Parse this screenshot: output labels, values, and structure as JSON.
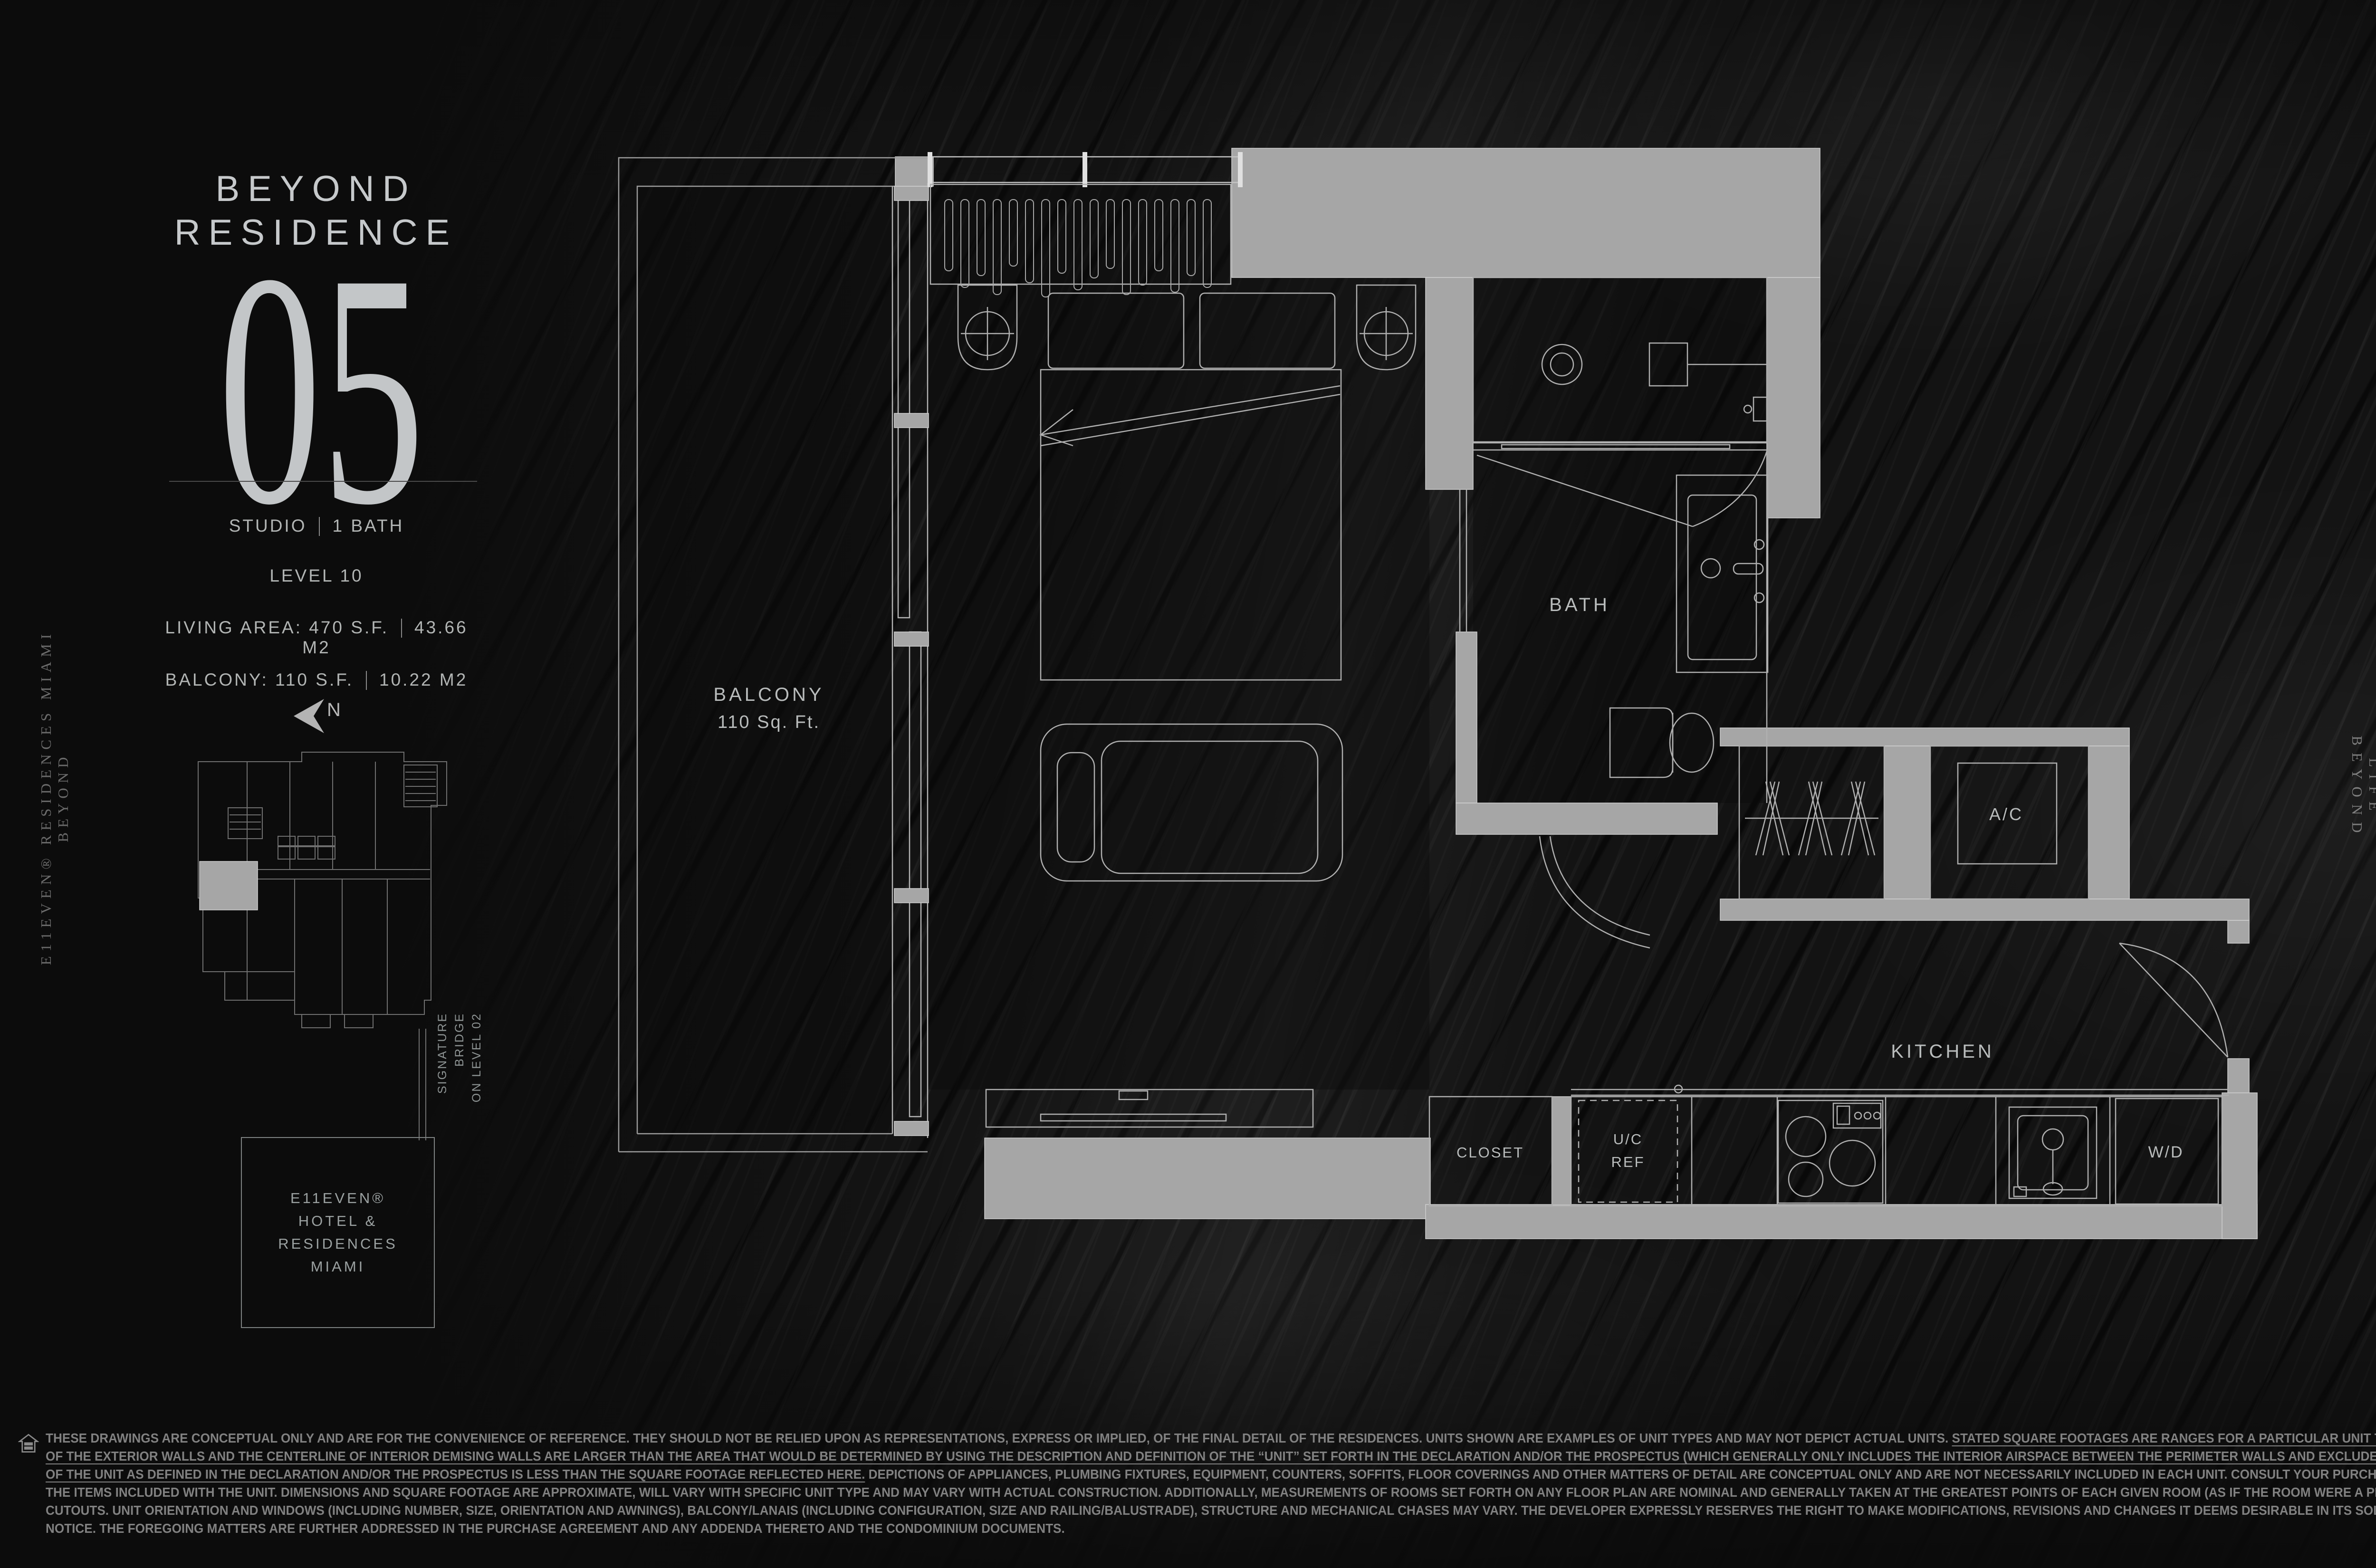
{
  "header": {
    "title_line1": "BEYOND",
    "title_line2": "RESIDENCE",
    "unit_number": "05"
  },
  "stats": {
    "unit_type": "STUDIO",
    "baths": "1 BATH",
    "level": "LEVEL 10",
    "living_area": "LIVING AREA: 470 S.F.",
    "living_area_metric": "43.66 M2",
    "balcony": "BALCONY: 110 S.F.",
    "balcony_metric": "10.22 M2"
  },
  "key_plan": {
    "north_label": "N",
    "annotation_lines": [
      "SIGNATURE",
      "BRIDGE",
      "ON LEVEL 02"
    ],
    "building_label_line1": "E11EVEN®",
    "building_label_line2": "HOTEL & RESIDENCES",
    "building_label_line3": "MIAMI"
  },
  "floor_plan": {
    "balcony_label": "BALCONY",
    "balcony_area": "110 Sq. Ft.",
    "bath_label": "BATH",
    "ac_label": "A/C",
    "kitchen_label": "KITCHEN",
    "closet_label": "CLOSET",
    "uc_ref_line1": "U/C",
    "uc_ref_line2": "REF",
    "wd_label": "W/D",
    "compass_west_label": "W"
  },
  "side_text": {
    "left_brand": "E11EVEN® RESIDENCES MIAMI BEYOND",
    "right_brand": "LIFE BEYOND"
  },
  "colors": {
    "background": "#131313",
    "wall_poche": "#a6a6a6",
    "line": "#b5b5b5",
    "text": "#c6c9cb",
    "dim_text": "#818181"
  },
  "disclaimer": {
    "lines": [
      [
        {
          "t": "THESE DRAWINGS ARE CONCEPTUAL ONLY AND ARE FOR THE CONVENIENCE OF REFERENCE. THEY SHOULD NOT BE RELIED UPON AS REPRESENTATIONS, EXPRESS OR IMPLIED, OF THE FINAL DETAIL OF THE RESIDENCES. UNITS SHOWN ARE EXAMPLES OF UNIT TYPES AND MAY NOT DEPICT ACTUAL UNITS. ",
          "u": false
        },
        {
          "t": "STATED SQUARE FOOTAGES ARE RANGES FOR A PARTICULAR UNIT TYPE AND ARE MEASURED TO THE EXTERIOR BOUNDARIES",
          "u": true
        }
      ],
      [
        {
          "t": "OF THE EXTERIOR WALLS AND THE CENTERLINE OF INTERIOR DEMISING WALLS ARE LARGER THAN THE AREA THAT WOULD BE DETERMINED BY USING THE DESCRIPTION AND DEFINITION OF THE “UNIT” SET FORTH IN THE DECLARATION AND/OR THE PROSPECTUS (WHICH GENERALLY ONLY INCLUDES THE INTERIOR AIRSPACE BETWEEN THE PERIMETER WALLS AND EXCLUDES INTERIOR STRUCTURAL COMPONENTS). THE AREA",
          "u": true
        }
      ],
      [
        {
          "t": "OF THE UNIT AS DEFINED IN THE DECLARATION AND/OR THE PROSPECTUS IS LESS THAN THE SQUARE FOOTAGE REFLECTED HERE.",
          "u": true
        },
        {
          "t": " DEPICTIONS OF APPLIANCES, PLUMBING FIXTURES, EQUIPMENT, COUNTERS, SOFFITS, FLOOR COVERINGS AND OTHER MATTERS OF DETAIL ARE CONCEPTUAL ONLY AND ARE NOT NECESSARILY INCLUDED IN EACH UNIT. CONSULT YOUR PURCHASE AGREEMENT AND ANY ADDENDA THERETO FOR",
          "u": false
        }
      ],
      [
        {
          "t": "THE ITEMS INCLUDED WITH THE UNIT. DIMENSIONS AND SQUARE FOOTAGE ARE APPROXIMATE, WILL VARY WITH SPECIFIC UNIT TYPE AND MAY VARY WITH ACTUAL CONSTRUCTION. ADDITIONALLY, MEASUREMENTS OF ROOMS SET FORTH ON ANY FLOOR PLAN ARE NOMINAL AND GENERALLY TAKEN AT THE GREATEST POINTS OF EACH GIVEN ROOM (AS IF THE ROOM WERE A PERFECT RECTANGLE), WITHOUT REGARD FOR ANY",
          "u": false
        }
      ],
      [
        {
          "t": "CUTOUTS. UNIT ORIENTATION AND WINDOWS (INCLUDING NUMBER, SIZE, ORIENTATION AND AWNINGS), BALCONY/LANAIS (INCLUDING CONFIGURATION, SIZE AND RAILING/BALUSTRADE), STRUCTURE AND MECHANICAL CHASES MAY VARY. THE DEVELOPER EXPRESSLY RESERVES THE RIGHT TO MAKE MODIFICATIONS, REVISIONS AND CHANGES IT DEEMS DESIRABLE IN ITS SOLE AND ABSOLUTE DISCRETION AND WITHOUT",
          "u": false
        }
      ],
      [
        {
          "t": "NOTICE. THE FOREGOING MATTERS ARE FURTHER ADDRESSED IN THE PURCHASE AGREEMENT AND ANY ADDENDA THERETO AND THE CONDOMINIUM DOCUMENTS.",
          "u": false
        }
      ]
    ]
  }
}
